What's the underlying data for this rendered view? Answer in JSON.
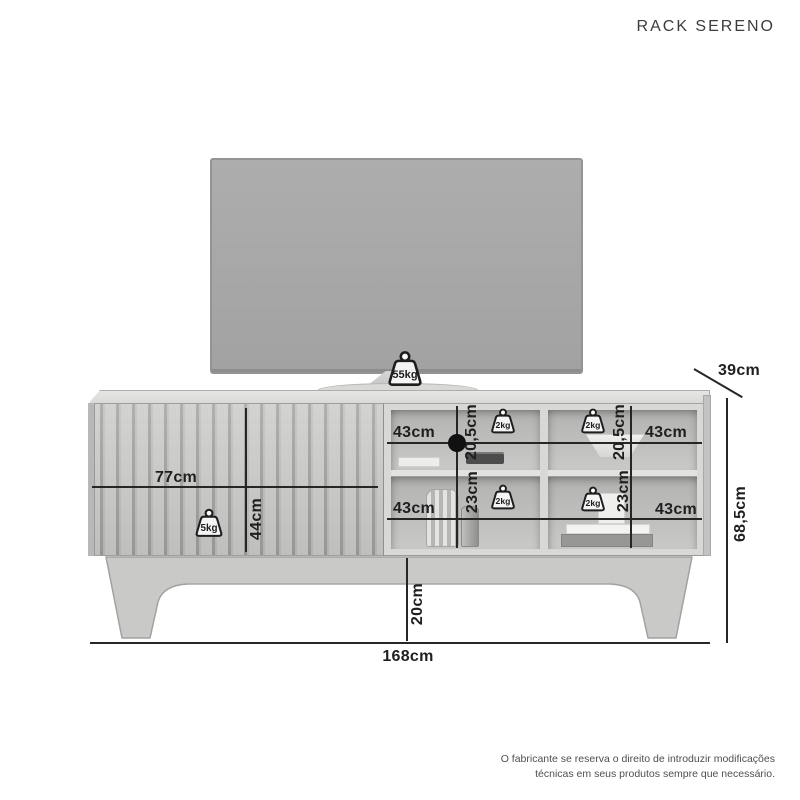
{
  "title": "RACK SERENO",
  "disclaimer": {
    "line1": "O fabricante se reserva o direito de introduzir modificações",
    "line2": "técnicas em seus produtos sempre que necessário."
  },
  "dims": {
    "total_width": "168cm",
    "total_height": "68,5cm",
    "depth": "39cm",
    "door_width": "77cm",
    "door_height": "44cm",
    "leg_height": "20cm"
  },
  "weights": {
    "tv": "55kg",
    "door": "5kg"
  },
  "compartments": [
    {
      "position": "middle-top",
      "width": "43cm",
      "height": "20,5cm",
      "max_load": "2kg"
    },
    {
      "position": "middle-bottom",
      "width": "43cm",
      "height": "23cm",
      "max_load": "2kg"
    },
    {
      "position": "right-top",
      "width": "43cm",
      "height": "20,5cm",
      "max_load": "2kg"
    },
    {
      "position": "right-bottom",
      "width": "43cm",
      "height": "23cm",
      "max_load": "2kg"
    }
  ],
  "colors": {
    "ink": "#262626",
    "furniture_light": "#d8d8d6",
    "furniture_mid": "#c9c9c8",
    "tv_screen": "#a8a8a8",
    "background": "#ffffff"
  }
}
